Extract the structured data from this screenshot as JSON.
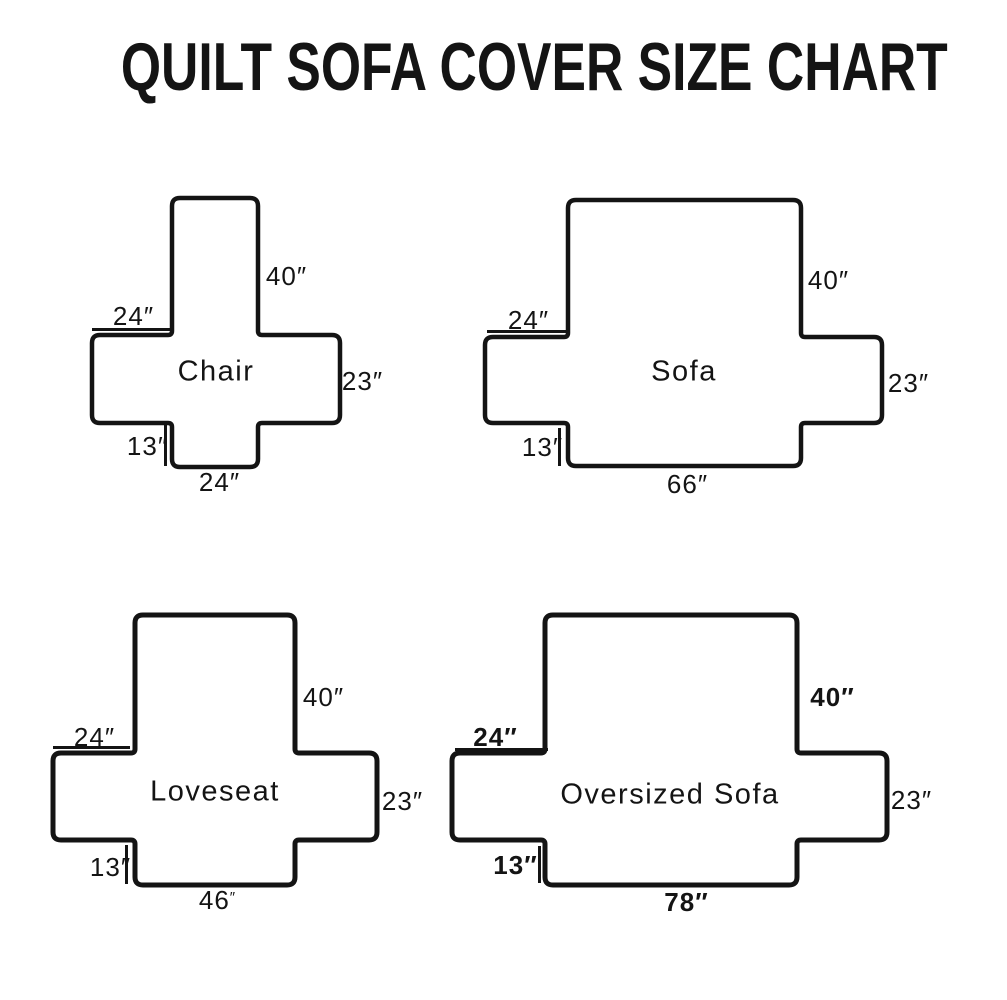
{
  "page_title": "QUILT SOFA COVER SIZE CHART",
  "colors": {
    "ink": "#141414",
    "background": "#ffffff"
  },
  "diagrams": [
    {
      "name": "Chair",
      "back_height": {
        "value": "40",
        "unit": "″"
      },
      "arm_width": {
        "value": "24",
        "unit": "″"
      },
      "side_height": {
        "value": "23",
        "unit": "″"
      },
      "front_drop": {
        "value": "13",
        "unit": "″"
      },
      "front_width": {
        "value": "24",
        "unit": "″"
      }
    },
    {
      "name": "Sofa",
      "back_height": {
        "value": "40",
        "unit": "″"
      },
      "arm_width": {
        "value": "24",
        "unit": "″"
      },
      "side_height": {
        "value": "23",
        "unit": "″"
      },
      "front_drop": {
        "value": "13",
        "unit": "″"
      },
      "front_width": {
        "value": "66",
        "unit": "″"
      }
    },
    {
      "name": "Loveseat",
      "back_height": {
        "value": "40",
        "unit": "″"
      },
      "arm_width": {
        "value": "24",
        "unit": "″"
      },
      "side_height": {
        "value": "23",
        "unit": "″"
      },
      "front_drop": {
        "value": "13",
        "unit": "″"
      },
      "front_width": {
        "value": "46",
        "unit": "″"
      }
    },
    {
      "name": "Oversized Sofa",
      "back_height": {
        "value": "40",
        "unit": "″"
      },
      "arm_width": {
        "value": "24",
        "unit": "″"
      },
      "side_height": {
        "value": "23",
        "unit": "″"
      },
      "front_drop": {
        "value": "13",
        "unit": "″"
      },
      "front_width": {
        "value": "78",
        "unit": "″"
      }
    }
  ]
}
